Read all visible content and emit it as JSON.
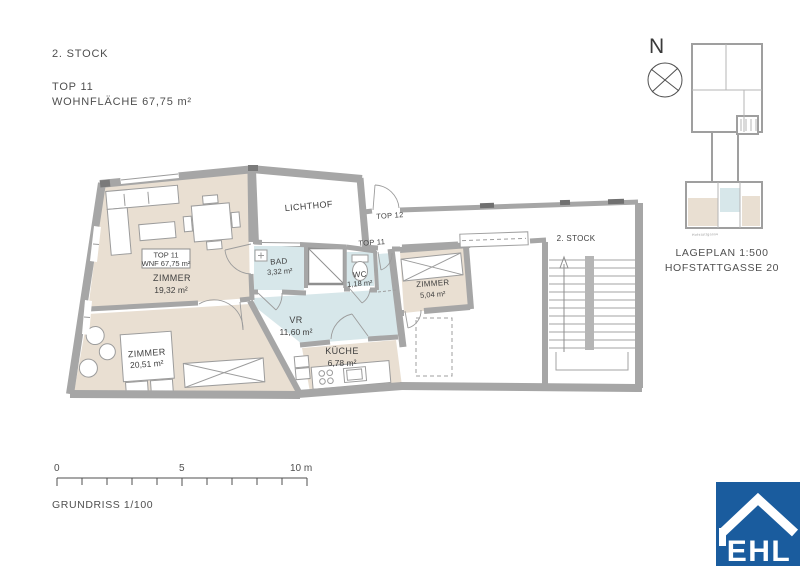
{
  "header": {
    "floor": "2. STOCK",
    "unit": "TOP 11",
    "area": "WOHNFLÄCHE 67,75 m²"
  },
  "plan": {
    "unit_box": {
      "line1": "TOP 11",
      "line2": "WNF 67,75 m²"
    },
    "living": {
      "name": "ZIMMER",
      "area": "19,32 m²"
    },
    "bedroom": {
      "name": "ZIMMER",
      "area": "20,51 m²"
    },
    "small_room": {
      "name": "ZIMMER",
      "area": "5,04 m²"
    },
    "kitchen": {
      "name": "KÜCHE",
      "area": "6,78 m²"
    },
    "hall": {
      "name": "VR",
      "area": "11,60 m²"
    },
    "bath": {
      "name": "BAD",
      "area": "3,32 m²"
    },
    "wc": {
      "name": "WC",
      "area": "1,18 m²"
    },
    "lichthof": {
      "name": "LICHTHOF"
    },
    "top12_door": "TOP 12",
    "top11_door": "TOP 11",
    "staircase": "2. STOCK"
  },
  "siteplan": {
    "north": "N",
    "caption_line1": "LAGEPLAN 1:500",
    "caption_line2": "HOFSTATTGASSE 20",
    "street": "Hofstattgasse"
  },
  "scalebar": {
    "t0": "0",
    "t5": "5",
    "t10": "10 m",
    "caption": "GRUNDRISS 1/100"
  },
  "logo": {
    "text": "EHL"
  },
  "colors": {
    "room_beige": "#e9dfd2",
    "room_blue": "#d7e7ea",
    "wall_gray": "#a6a6a6",
    "logo_blue": "#1a5c9e"
  }
}
